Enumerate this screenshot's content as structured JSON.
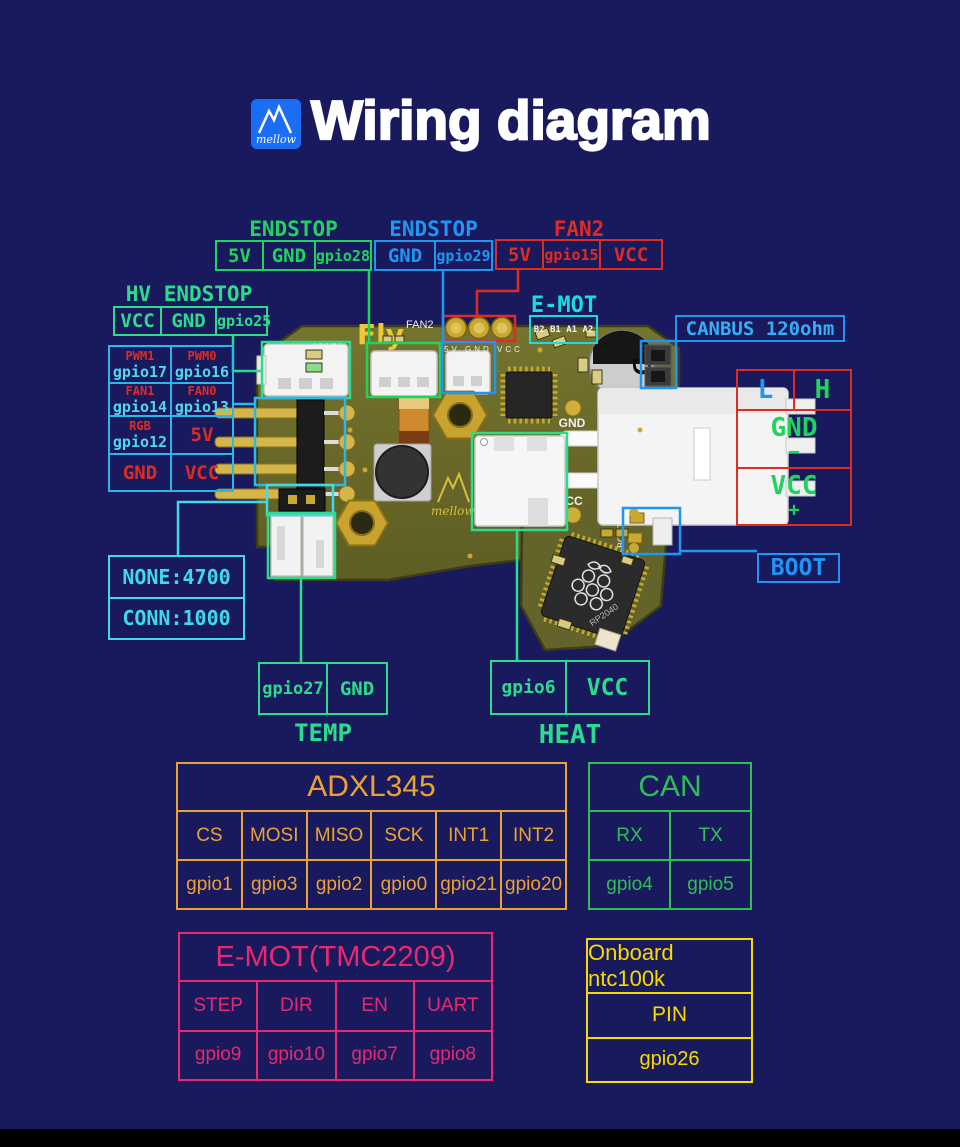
{
  "header": {
    "title": "Wiring diagram",
    "logo": "mellow"
  },
  "colors": {
    "background": "#191a5e",
    "green": "#1ed45c",
    "blue": "#1f96f4",
    "red": "#e02b22",
    "spring_green": "#2bdc8a",
    "cyan": "#3fd9e8",
    "table_cyan": "#2bb7ea",
    "orange": "#eba233",
    "can_green": "#2fbe55",
    "pink": "#e9296f",
    "yellow": "#f6da00",
    "pcb_olive": "#6d6c2c",
    "gold": "#cfae3a"
  },
  "pin_groups": {
    "endstop_left": {
      "title": "ENDSTOP",
      "cells": [
        "5V",
        "GND",
        "gpio28"
      ]
    },
    "endstop_mid": {
      "title": "ENDSTOP",
      "cells": [
        "GND",
        "gpio29"
      ]
    },
    "fan2": {
      "title": "FAN2",
      "cells": [
        "5V",
        "gpio15",
        "VCC"
      ]
    },
    "hv_endstop": {
      "title": "HV ENDSTOP",
      "cells": [
        "VCC",
        "GND",
        "gpio25"
      ]
    },
    "emot": {
      "title": "E-MOT",
      "pins": "B2 B1 A1 A2"
    },
    "canbus": {
      "label": "CANBUS 120ohm"
    },
    "boot": {
      "label": "BOOT"
    },
    "temp": {
      "title": "TEMP",
      "cells": [
        "gpio27",
        "GND"
      ]
    },
    "heat": {
      "title": "HEAT",
      "cells": [
        "gpio6",
        "VCC"
      ]
    }
  },
  "io_table": {
    "cells": [
      {
        "label": "PWM1",
        "gpio": "gpio17"
      },
      {
        "label": "PWM0",
        "gpio": "gpio16"
      },
      {
        "label": "FAN1",
        "gpio": "gpio14"
      },
      {
        "label": "FAN0",
        "gpio": "gpio13"
      },
      {
        "label": "RGB",
        "gpio": "gpio12"
      },
      {
        "label": "5V"
      },
      {
        "label": "GND"
      },
      {
        "label": "VCC"
      }
    ]
  },
  "lh_table": {
    "low": "L",
    "high": "H",
    "gnd": "GND",
    "minus": "−",
    "vcc": "VCC",
    "plus": "+"
  },
  "pullup_table": {
    "rows": [
      "NONE:4700",
      "CONN:1000"
    ]
  },
  "bottom_tables": {
    "adxl345": {
      "title": "ADXL345",
      "headers": [
        "CS",
        "MOSI",
        "MISO",
        "SCK",
        "INT1",
        "INT2"
      ],
      "values": [
        "gpio1",
        "gpio3",
        "gpio2",
        "gpio0",
        "gpio21",
        "gpio20"
      ]
    },
    "can": {
      "title": "CAN",
      "headers": [
        "RX",
        "TX"
      ],
      "values": [
        "gpio4",
        "gpio5"
      ]
    },
    "emot_driver": {
      "title": "E-MOT(TMC2209)",
      "headers": [
        "STEP",
        "DIR",
        "EN",
        "UART"
      ],
      "values": [
        "gpio9",
        "gpio10",
        "gpio7",
        "gpio8"
      ]
    },
    "ntc": {
      "title": "Onboard ntc100k",
      "header": "PIN",
      "value": "gpio26"
    }
  },
  "board_silkscreen": {
    "fly": "Fly",
    "fan2": "FAN2",
    "fan2_pins": "5V GND VCC",
    "hv_in": "HV-IN",
    "gnd": "GND",
    "vcc": "VCC",
    "mellow": "mellow",
    "boot": "BOOT",
    "rp2040": "RP2040",
    "cap_mark": "D"
  }
}
